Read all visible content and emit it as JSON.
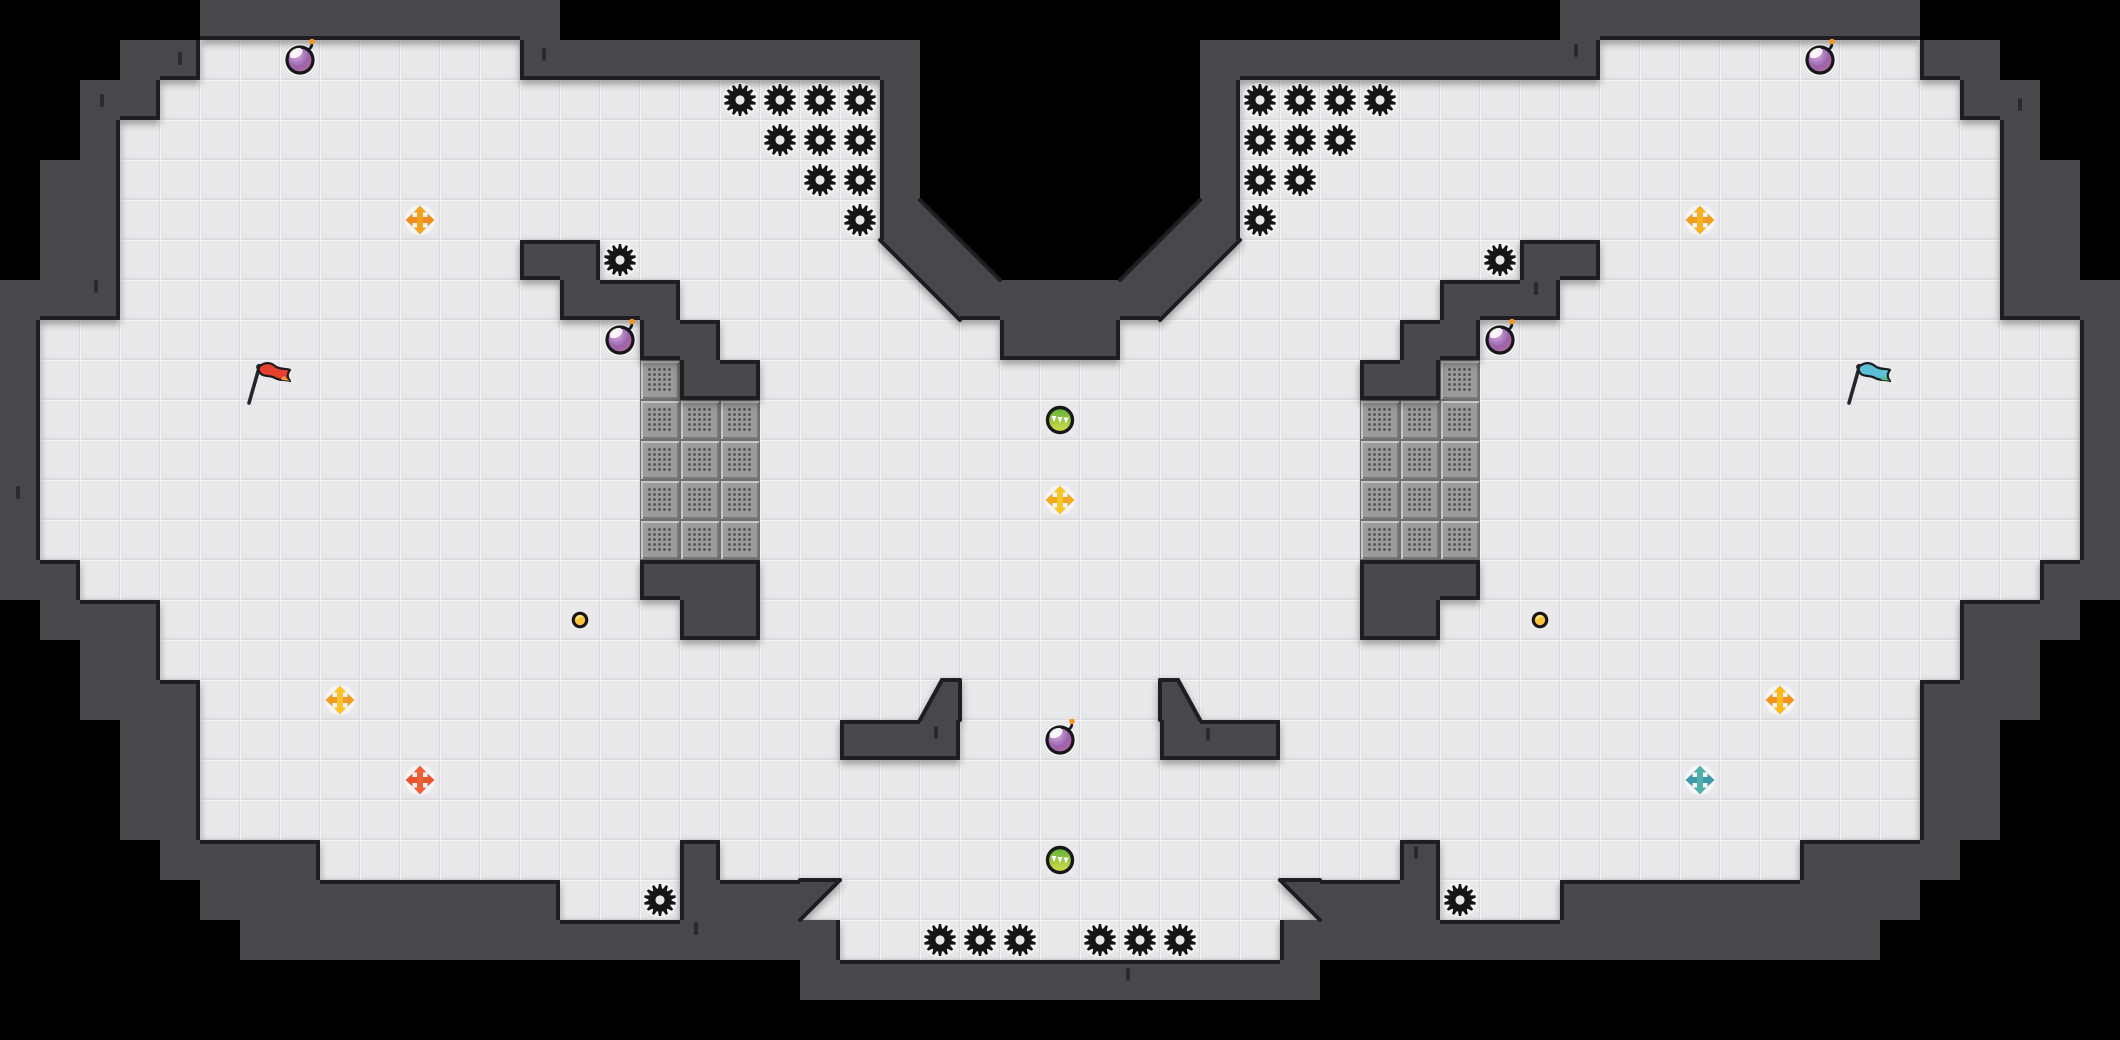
{
  "meta": {
    "cols": 53,
    "rows": 26,
    "tile": 40,
    "width": 2120,
    "height": 1040
  },
  "colors": {
    "void": "#000000",
    "wall": "#48484C",
    "outline": "#1E1E22",
    "floor": "#E9E9EB",
    "floor_line": "#DADADE",
    "floor_highlight": "#F4F4F6",
    "brick": "#9C9C9C",
    "brick_highlight": "#C6C6C6",
    "brick_shadow": "#787878",
    "brick_edge": "#6E6E6E",
    "brick_dot": "#5A5A5A",
    "gear": "#161616",
    "item_ring": "#17171A",
    "bomb_top": "#D7B5DE",
    "bomb_mid": "#9C63AE",
    "bomb_bottom": "#C06A92",
    "bomb_spark": "#F7941D",
    "orb_green_top": "#5FAE3B",
    "orb_green_bottom": "#D6E049",
    "coin_fill": "#F6C33C",
    "coin_shine": "#FFE794"
  },
  "map": {
    "legend": {
      " ": "void",
      "#": "wall",
      ".": "floor",
      "B": "brick-block",
      "a": "diagonal wall lower-left (void upper-right)",
      "b": "diagonal wall lower-right (void upper-left)",
      "c": "diagonal wall upper-right (floor lower-left)",
      "d": "diagonal wall upper-left (floor lower-right)",
      "e": "wall with upper-left corner chamfer",
      "f": "wall with upper-right corner chamfer"
    },
    "rows": [
      "     #########                         #########     ",
      "   ##........##########       ##########........##   ",
      "  ##..................#       #..................##  ",
      "  #...................#       #...................#  ",
      " ##...................#       #...................## ",
      " ##...................#a     b#...................## ",
      " ##..........##.......c#a   b#d.......##..........## ",
      "###...........###......c#####d......###...........###",
      "#...............##.......###.......##...............#",
      "#...............B##...............##B...............#",
      "#...............BBB...............BBB...............#",
      "#...............BBB...............BBB...............#",
      "#...............BBB...............BBB...............#",
      "#...............BBB...............BBB...............#",
      "##..............###...............###..............##",
      " ###.............##...............##.............### ",
      "  ##.............................................##  ",
      "  ###..................e.....f..................###  ",
      "   ##................###.....###................##   ",
      "   ##...........................................##   ",
      "   ##...........................................##   ",
      "    ####.........#.................#.........####    ",
      "     #########...###d...........c###...#########     ",
      "      ###############...........###############      ",
      "                    #############                    ",
      "                                                     "
    ]
  },
  "items": {
    "gears": [
      [
        18.5,
        2.5
      ],
      [
        19.5,
        2.5
      ],
      [
        20.5,
        2.5
      ],
      [
        21.5,
        2.5
      ],
      [
        19.5,
        3.5
      ],
      [
        20.5,
        3.5
      ],
      [
        21.5,
        3.5
      ],
      [
        20.5,
        4.5
      ],
      [
        21.5,
        4.5
      ],
      [
        21.5,
        5.5
      ],
      [
        31.5,
        2.5
      ],
      [
        32.5,
        2.5
      ],
      [
        33.5,
        2.5
      ],
      [
        34.5,
        2.5
      ],
      [
        31.5,
        3.5
      ],
      [
        32.5,
        3.5
      ],
      [
        33.5,
        3.5
      ],
      [
        31.5,
        4.5
      ],
      [
        32.5,
        4.5
      ],
      [
        31.5,
        5.5
      ],
      [
        15.5,
        6.5
      ],
      [
        37.5,
        6.5
      ],
      [
        16.5,
        22.5
      ],
      [
        36.5,
        22.5
      ],
      [
        23.5,
        23.5
      ],
      [
        24.5,
        23.5
      ],
      [
        25.5,
        23.5
      ],
      [
        27.5,
        23.5
      ],
      [
        28.5,
        23.5
      ],
      [
        29.5,
        23.5
      ]
    ],
    "bombs": [
      [
        7.5,
        1.5
      ],
      [
        45.5,
        1.5
      ],
      [
        15.5,
        8.5
      ],
      [
        37.5,
        8.5
      ],
      [
        26.5,
        18.5
      ]
    ],
    "green_orbs": [
      [
        26.5,
        10.5
      ],
      [
        26.5,
        21.5
      ]
    ],
    "coins": [
      [
        14.5,
        15.5
      ],
      [
        38.5,
        15.5
      ]
    ],
    "crosses": [
      {
        "x": 10.5,
        "y": 5.5,
        "color": "#F3A11F",
        "accent": "#EE8E1E"
      },
      {
        "x": 42.5,
        "y": 5.5,
        "color": "#F8B324",
        "accent": "#F09D20"
      },
      {
        "x": 26.5,
        "y": 12.5,
        "color": "#F6C62B",
        "accent": "#F0A81F"
      },
      {
        "x": 8.5,
        "y": 17.5,
        "color": "#FBC32E",
        "accent": "#F2991F"
      },
      {
        "x": 44.5,
        "y": 17.5,
        "color": "#FBBB1C",
        "accent": "#F2941C"
      },
      {
        "x": 10.5,
        "y": 19.5,
        "color": "#EE5F35",
        "accent": "#E8542C"
      },
      {
        "x": 42.5,
        "y": 19.5,
        "color": "#4FB0AB",
        "accent": "#3E98A8"
      }
    ],
    "flags": [
      {
        "name": "red",
        "x": 6.4,
        "y": 9.55,
        "cloth": "#E8402F",
        "tip": "#F59C38"
      },
      {
        "name": "teal",
        "x": 46.4,
        "y": 9.55,
        "cloth": "#5BBFD6",
        "tip": "#53C07E"
      }
    ]
  },
  "cracks": [
    [
      4.5,
      1.45
    ],
    [
      2.55,
      2.5
    ],
    [
      2.4,
      7.15
    ],
    [
      0.45,
      12.3
    ],
    [
      13.6,
      1.35
    ],
    [
      39.4,
      1.25
    ],
    [
      38.4,
      7.2
    ],
    [
      17.4,
      23.2
    ],
    [
      23.4,
      18.3
    ],
    [
      30.2,
      18.35
    ],
    [
      28.2,
      24.35
    ],
    [
      35.4,
      21.3
    ],
    [
      50.5,
      2.6
    ]
  ]
}
